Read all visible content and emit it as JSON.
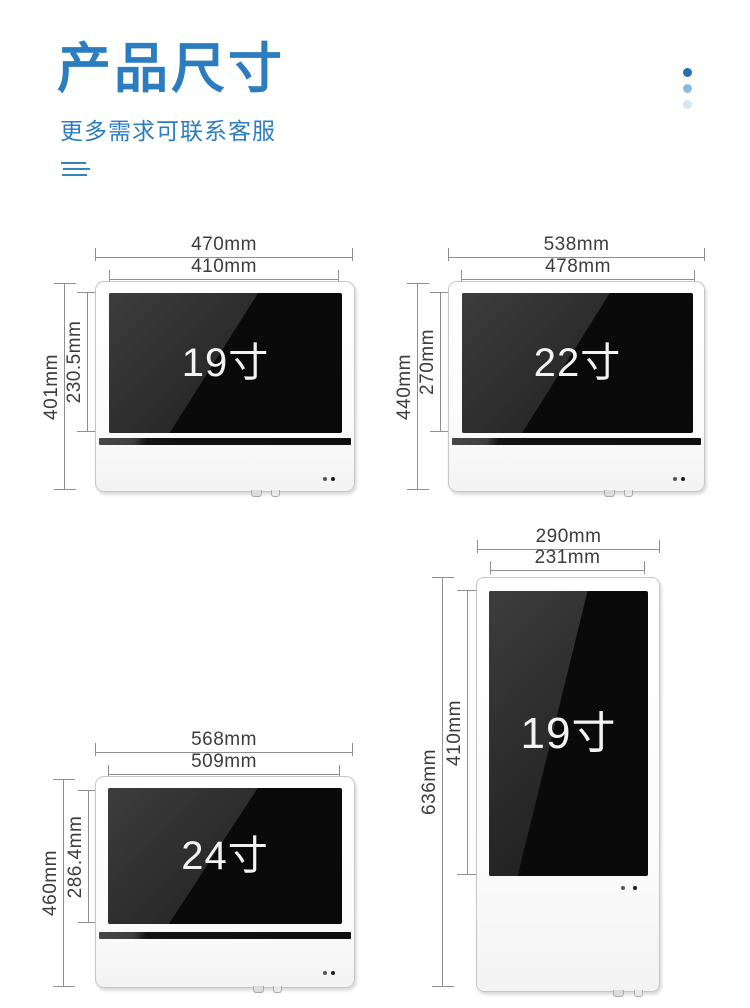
{
  "header": {
    "title": "产品尺寸",
    "subtitle": "更多需求可联系客服",
    "accent_color": "#2b7dc0",
    "dot_colors": [
      "#1f72b8",
      "#8fb8dc",
      "#d6e6f4"
    ]
  },
  "products": [
    {
      "label": "19寸",
      "orientation": "landscape",
      "outer_width": "470mm",
      "screen_width": "410mm",
      "outer_height": "401mm",
      "screen_height": "230.5mm"
    },
    {
      "label": "22寸",
      "orientation": "landscape",
      "outer_width": "538mm",
      "screen_width": "478mm",
      "outer_height": "440mm",
      "screen_height": "270mm"
    },
    {
      "label": "24寸",
      "orientation": "landscape",
      "outer_width": "568mm",
      "screen_width": "509mm",
      "outer_height": "460mm",
      "screen_height": "286.4mm"
    },
    {
      "label": "19寸",
      "orientation": "portrait",
      "outer_width": "290mm",
      "screen_width": "231mm",
      "outer_height": "636mm",
      "screen_height": "410mm"
    }
  ]
}
